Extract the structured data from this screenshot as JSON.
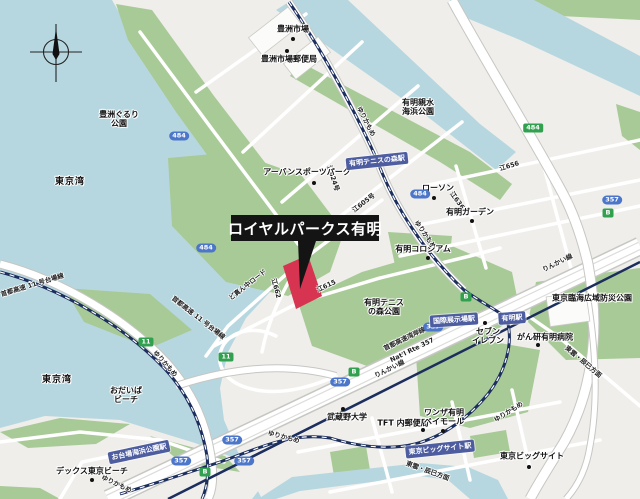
{
  "map": {
    "callout": "ロイヤルパークス有明",
    "colors": {
      "water": "#b7d7e0",
      "land": "#efeeea",
      "park": "#a8ca97",
      "road": "#ffffff",
      "road_casing": "#c6c6c3",
      "rail_navy": "#1c2e5e",
      "station_bg": "#4d5da0",
      "shield_blue": "#4b76c9",
      "shield_green": "#31a04f",
      "highlight_red": "#d63450",
      "callout_bg": "#141414"
    },
    "pois": [
      {
        "name": "toyosu-market",
        "lines": [
          "豊洲市場"
        ],
        "x": 293,
        "y": 30,
        "dot": [
          293,
          39
        ]
      },
      {
        "name": "toyosu-market-post-office",
        "lines": [
          "豊洲市場郵便局"
        ],
        "x": 289,
        "y": 60,
        "dot": [
          287,
          51
        ]
      },
      {
        "name": "toyosu-gururi-park",
        "lines": [
          "豊洲ぐるり",
          "公園"
        ],
        "x": 119,
        "y": 120
      },
      {
        "name": "tokyo-bay-north",
        "big": true,
        "lines": [
          "東京湾"
        ],
        "x": 70,
        "y": 183
      },
      {
        "name": "tokyo-bay-south",
        "big": true,
        "lines": [
          "東京湾"
        ],
        "x": 57,
        "y": 381
      },
      {
        "name": "urban-sports-park",
        "lines": [
          "アーバンスポーツパーク"
        ],
        "x": 307,
        "y": 173,
        "dot": [
          314,
          183
        ]
      },
      {
        "name": "ariake-shinsui-kaihin-park",
        "lines": [
          "有明親水",
          "海浜公園"
        ],
        "x": 418,
        "y": 108
      },
      {
        "name": "lawson",
        "lines": [
          "ローソン"
        ],
        "x": 438,
        "y": 189,
        "dot": [
          434,
          198
        ]
      },
      {
        "name": "ariake-garden",
        "lines": [
          "有明ガーデン"
        ],
        "x": 470,
        "y": 213,
        "dot": [
          472,
          221
        ]
      },
      {
        "name": "ariake-coliseum",
        "lines": [
          "有明コロシアム"
        ],
        "x": 423,
        "y": 250,
        "dot": [
          428,
          258
        ]
      },
      {
        "name": "ariake-tennis-no-mori-park",
        "lines": [
          "有明テニス",
          "の森公園"
        ],
        "x": 384,
        "y": 308
      },
      {
        "name": "musashino-university",
        "lines": [
          "武蔵野大学"
        ],
        "x": 347,
        "y": 418,
        "dot": [
          343,
          409
        ]
      },
      {
        "name": "tft-post-office",
        "lines": [
          "TFT 内郵便局"
        ],
        "x": 403,
        "y": 424,
        "dot": [
          423,
          430
        ]
      },
      {
        "name": "wanza-ariake-bay-mall",
        "lines": [
          "ワンザ有明",
          "ベイモール"
        ],
        "x": 444,
        "y": 418,
        "dot": [
          443,
          431
        ]
      },
      {
        "name": "ganken-ariake-hospital",
        "lines": [
          "がん研有明病院"
        ],
        "x": 545,
        "y": 338,
        "dot": [
          538,
          345
        ]
      },
      {
        "name": "seven-eleven",
        "lines": [
          "セブン",
          "イレブン"
        ],
        "x": 488,
        "y": 337,
        "dot": [
          485,
          323
        ]
      },
      {
        "name": "tokyo-rinkai-disaster-prevention-park",
        "lines": [
          "東京臨海広域防災公園"
        ],
        "x": 592,
        "y": 299
      },
      {
        "name": "tokyo-big-sight",
        "lines": [
          "東京ビッグサイト"
        ],
        "x": 532,
        "y": 457,
        "dot": [
          529,
          467
        ]
      },
      {
        "name": "odaiba-beach",
        "lines": [
          "おだいば",
          "ビーチ"
        ],
        "x": 126,
        "y": 396
      },
      {
        "name": "decks-tokyo-beach",
        "lines": [
          "デックス東京ビーチ"
        ],
        "x": 92,
        "y": 472,
        "dot": [
          92,
          480
        ]
      }
    ],
    "stations": [
      {
        "name": "ariake-tennis-no-mori-station",
        "label": "有明テニスの森駅",
        "x": 377,
        "y": 161,
        "rot": -6
      },
      {
        "name": "ariake-station",
        "label": "有明駅",
        "x": 512,
        "y": 318,
        "rot": -4
      },
      {
        "name": "kokusai-tenjijo-station",
        "label": "国際展示場駅",
        "x": 454,
        "y": 320,
        "rot": -4
      },
      {
        "name": "tokyo-big-sight-station",
        "label": "東京ビッグサイト駅",
        "x": 440,
        "y": 449,
        "rot": -6
      },
      {
        "name": "odaiba-kaihin-koen-station",
        "label": "お台場海浜公園駅",
        "x": 139,
        "y": 452,
        "rot": -12
      }
    ],
    "shields": [
      {
        "text": "484",
        "type": "blue",
        "x": 179,
        "y": 136
      },
      {
        "text": "484",
        "type": "blue",
        "x": 206,
        "y": 248
      },
      {
        "text": "484",
        "type": "blue",
        "x": 420,
        "y": 194
      },
      {
        "text": "484",
        "type": "green",
        "x": 533,
        "y": 128
      },
      {
        "text": "357",
        "type": "blue",
        "x": 340,
        "y": 382
      },
      {
        "text": "357",
        "type": "blue",
        "x": 433,
        "y": 327
      },
      {
        "text": "357",
        "type": "blue",
        "x": 612,
        "y": 200
      },
      {
        "text": "357",
        "type": "blue",
        "x": 232,
        "y": 440
      },
      {
        "text": "357",
        "type": "blue",
        "x": 244,
        "y": 461
      },
      {
        "text": "357",
        "type": "blue",
        "x": 181,
        "y": 461
      },
      {
        "text": "B",
        "type": "green",
        "x": 608,
        "y": 213
      },
      {
        "text": "B",
        "type": "green",
        "x": 354,
        "y": 372
      },
      {
        "text": "B",
        "type": "green",
        "x": 205,
        "y": 472
      },
      {
        "text": "B",
        "type": "green",
        "x": 466,
        "y": 297
      },
      {
        "text": "11",
        "type": "green",
        "x": 146,
        "y": 342
      },
      {
        "text": "11",
        "type": "green",
        "x": 226,
        "y": 357
      }
    ],
    "road_labels": [
      {
        "text": "首都高速 11 号台場線",
        "x": 32,
        "y": 284,
        "rot": -17
      },
      {
        "text": "首都高速 11 号台場線",
        "x": 199,
        "y": 317,
        "rot": 38
      },
      {
        "text": "ゆりかもめ",
        "x": 367,
        "y": 121,
        "rot": 63
      },
      {
        "text": "ゆりかもめ",
        "x": 426,
        "y": 234,
        "rot": 55
      },
      {
        "text": "ゆりかもめ",
        "x": 284,
        "y": 436,
        "rot": 15
      },
      {
        "text": "ゆりかもめ",
        "x": 117,
        "y": 483,
        "rot": 25
      },
      {
        "text": "ゆりかもめ",
        "x": 508,
        "y": 411,
        "rot": -32
      },
      {
        "text": "ゆりかもめ",
        "x": 166,
        "y": 363,
        "rot": 48
      },
      {
        "text": "りんかい線",
        "x": 557,
        "y": 262,
        "rot": -26
      },
      {
        "text": "りんかい線",
        "x": 389,
        "y": 368,
        "rot": -26
      },
      {
        "text": "首都高速湾岸線",
        "x": 404,
        "y": 338,
        "rot": -26
      },
      {
        "text": "Nat'l Rte 357",
        "x": 412,
        "y": 350,
        "rot": -26
      },
      {
        "text": "東雲・辰巳方面",
        "x": 584,
        "y": 361,
        "rot": 40
      },
      {
        "text": "東雲・辰巳方面",
        "x": 428,
        "y": 470,
        "rot": 20
      },
      {
        "text": "江624号",
        "x": 334,
        "y": 178,
        "rot": 72
      },
      {
        "text": "江605号",
        "x": 363,
        "y": 202,
        "rot": -38
      },
      {
        "text": "江615",
        "x": 326,
        "y": 285,
        "rot": -25
      },
      {
        "text": "江662",
        "x": 277,
        "y": 288,
        "rot": 75
      },
      {
        "text": "江636",
        "x": 458,
        "y": 200,
        "rot": 55
      },
      {
        "text": "江656",
        "x": 509,
        "y": 165,
        "rot": -17
      },
      {
        "text": "ど真ん中ロード",
        "x": 247,
        "y": 284,
        "rot": -38
      }
    ]
  }
}
